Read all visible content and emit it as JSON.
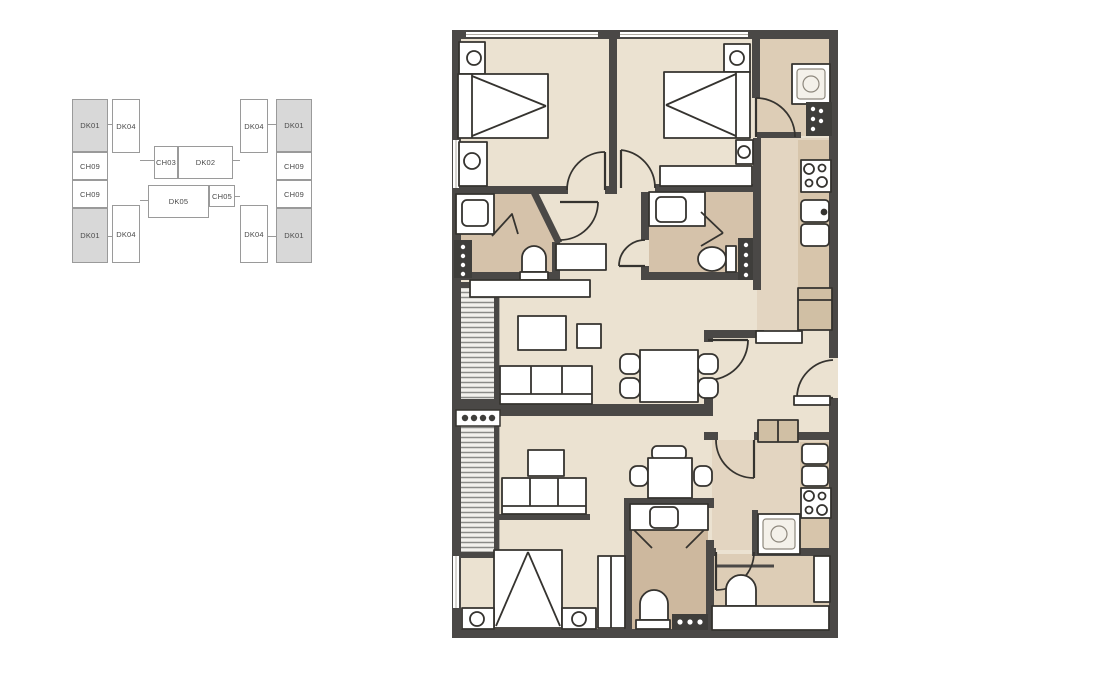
{
  "key_plan": {
    "units": [
      {
        "label": "DK01",
        "highlighted": true
      },
      {
        "label": "DK04",
        "highlighted": false
      },
      {
        "label": "CH09",
        "highlighted": false
      },
      {
        "label": "CH09",
        "highlighted": false
      },
      {
        "label": "DK01",
        "highlighted": true
      },
      {
        "label": "DK04",
        "highlighted": false
      },
      {
        "label": "CH03",
        "highlighted": false
      },
      {
        "label": "DK02",
        "highlighted": false
      },
      {
        "label": "DK05",
        "highlighted": false
      },
      {
        "label": "CH05",
        "highlighted": false
      },
      {
        "label": "DK04",
        "highlighted": false
      },
      {
        "label": "DK01",
        "highlighted": true
      },
      {
        "label": "CH09",
        "highlighted": false
      },
      {
        "label": "CH09",
        "highlighted": false
      },
      {
        "label": "DK04",
        "highlighted": false
      },
      {
        "label": "DK01",
        "highlighted": true
      }
    ],
    "highlighted_unit": "DK01",
    "colors": {
      "highlight": "#d8d8d8",
      "box_bg": "#ffffff",
      "box_border": "#9a9a9a",
      "text": "#4a4a4a"
    }
  },
  "floor_plan": {
    "colors": {
      "wall": "#4a4846",
      "floor_cream": "#ebe2d1",
      "floor_tan": "#ddcdb6",
      "floor_brown": "#d5c2aa",
      "counter_tan": "#d7c5ab",
      "furniture_fill": "#ffffff",
      "furniture_line": "#35332f",
      "louver_bg": "#f3f1ed",
      "louver_line": "#8b8b88"
    },
    "fixtures": [
      "double-bed",
      "double-bed",
      "single-bed",
      "nightstand-lamp",
      "sofa",
      "sofa",
      "coffee-table",
      "tv",
      "dining-table",
      "dining-table",
      "toilet",
      "toilet",
      "toilet",
      "toilet",
      "sink",
      "sink",
      "sink",
      "shower",
      "washing-machine",
      "washing-machine",
      "stove",
      "stove",
      "kitchen-sink",
      "kitchen-sink",
      "wardrobe",
      "louver-grille",
      "louver-grille",
      "door-arc"
    ]
  }
}
